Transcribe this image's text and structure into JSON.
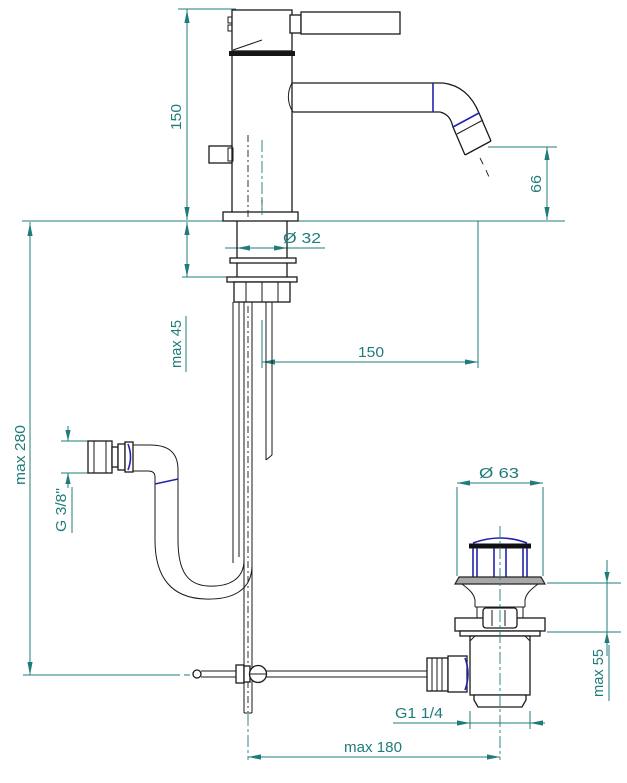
{
  "drawing": {
    "type": "technical-dimension-drawing",
    "subject": "single-lever basin mixer tap with flexible supply hose and pop-up waste drain",
    "colors": {
      "dimension_lines": "#1f7c7a",
      "object_lines": "#1a1a1a",
      "accent_navy": "#2323aa",
      "flange_gray": "#a8a8a8",
      "background": "#ffffff"
    },
    "labels": {
      "body_height": "150",
      "spout_height": "66",
      "shank_diameter": "Ø 32",
      "deck_thickness": "max 45",
      "spout_reach": "150",
      "hose_length": "max 280",
      "hose_thread": "G 3/8\"",
      "plug_diameter": "Ø 63",
      "drain_clamp_range": "max 55",
      "drain_thread": "G1 1/4",
      "rod_reach": "max 180"
    }
  }
}
